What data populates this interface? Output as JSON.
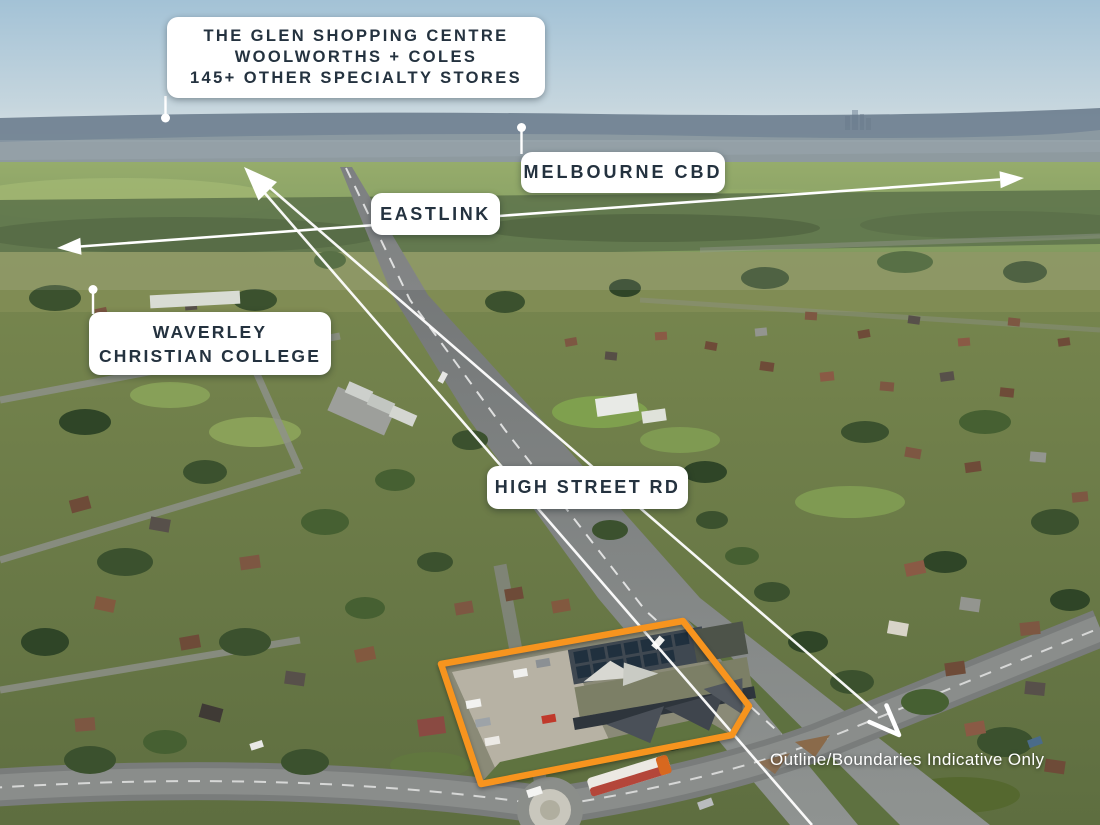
{
  "annotations": {
    "glen": {
      "line1": "THE GLEN SHOPPING CENTRE",
      "line2": "WOOLWORTHS + COLES",
      "line3": "145+ OTHER SPECIALTY STORES"
    },
    "melbourne_cbd": {
      "label": "MELBOURNE CBD"
    },
    "eastlink": {
      "label": "EASTLINK"
    },
    "waverley": {
      "line1": "WAVERLEY",
      "line2": "CHRISTIAN COLLEGE"
    },
    "high_street": {
      "label": "HIGH STREET RD"
    },
    "disclaimer": {
      "label": "Outline/Boundaries Indicative Only"
    }
  },
  "colors": {
    "property_outline": "#F7941E",
    "label_background": "#FFFFFF",
    "label_text": "#24323F",
    "annotation_lines": "#FFFFFF"
  }
}
